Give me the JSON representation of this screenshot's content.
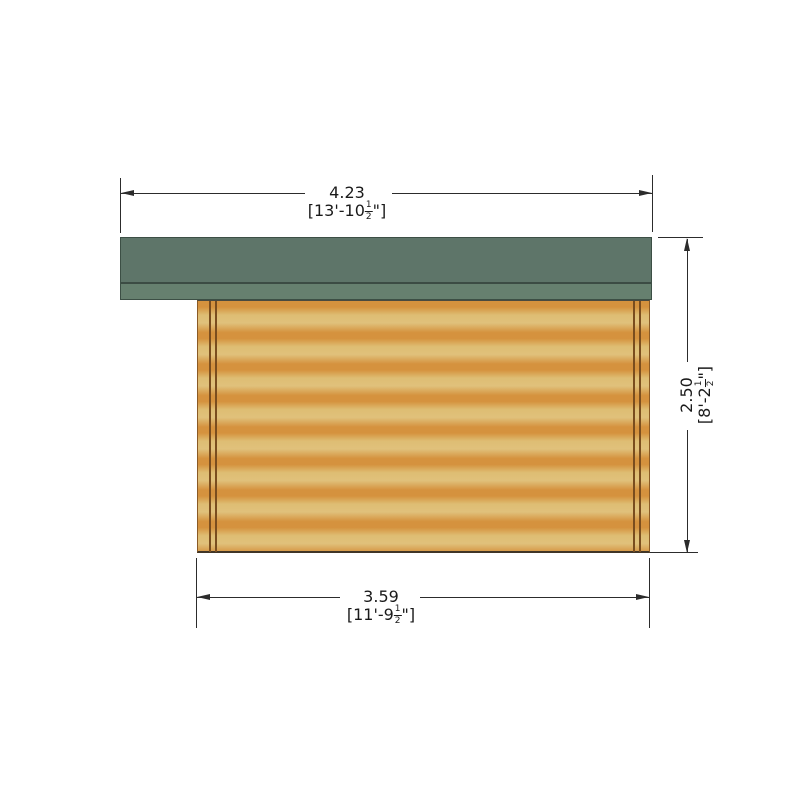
{
  "drawing": {
    "type": "side-elevation",
    "subject": "log-cabin"
  },
  "dimensions": {
    "top": {
      "metric": "4.23",
      "imperial_prefix": "[13'-10",
      "frac_num": "1",
      "frac_den": "2",
      "imperial_suffix": "\"]"
    },
    "right": {
      "metric": "2.50",
      "imperial_prefix": "[8'-2",
      "frac_num": "1",
      "frac_den": "2",
      "imperial_suffix": "\"]"
    },
    "bottom": {
      "metric": "3.59",
      "imperial_prefix": "[11'-9",
      "frac_num": "1",
      "frac_den": "2",
      "imperial_suffix": "\"]"
    }
  },
  "colors": {
    "background": "#ffffff",
    "roof_main": "#5e7569",
    "roof_fascia": "#66806f",
    "roof_edge": "#3c4f45",
    "wood_light": "#debd73",
    "wood_dark": "#d5923e",
    "corner_post_line": "#7a4d1e",
    "dimension_line": "#2c2c2c",
    "text": "#1a1a1a"
  }
}
